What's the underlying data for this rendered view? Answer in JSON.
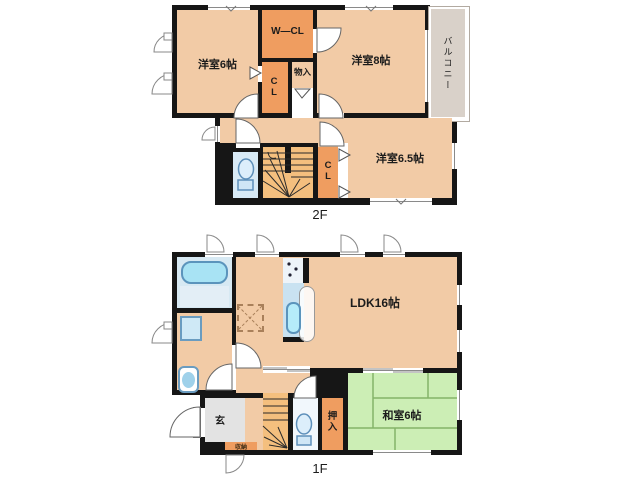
{
  "f2": {
    "floor_label": "2F",
    "rooms": {
      "yoshitsu6": "洋室6帖",
      "wcl": "W—CL",
      "cl_upper": "CL",
      "monoire": "物入",
      "yoshitsu8": "洋室8帖",
      "balcony": "バルコニー",
      "cl_lower": "CL",
      "yoshitsu65": "洋室6.5帖"
    }
  },
  "f1": {
    "floor_label": "1F",
    "rooms": {
      "ldk": "LDK16帖",
      "washitsu": "和室6帖",
      "genkan": "玄",
      "oshiire": "押入",
      "shuno": "収納"
    }
  },
  "colors": {
    "wall": "#161616",
    "room_peach": "#f2cba6",
    "closet_orange": "#ef9d60",
    "stairs_tan": "#f4bf7e",
    "tatami_green": "#cceeb5",
    "tatami_line": "#84b368",
    "balcony_gray": "#d9d1c9",
    "genkan_gray": "#e3e3e3",
    "bath_blue": "#d7e9f3",
    "tub_cyan": "#a8e3f4",
    "fixture_outline": "#5b94bc"
  }
}
